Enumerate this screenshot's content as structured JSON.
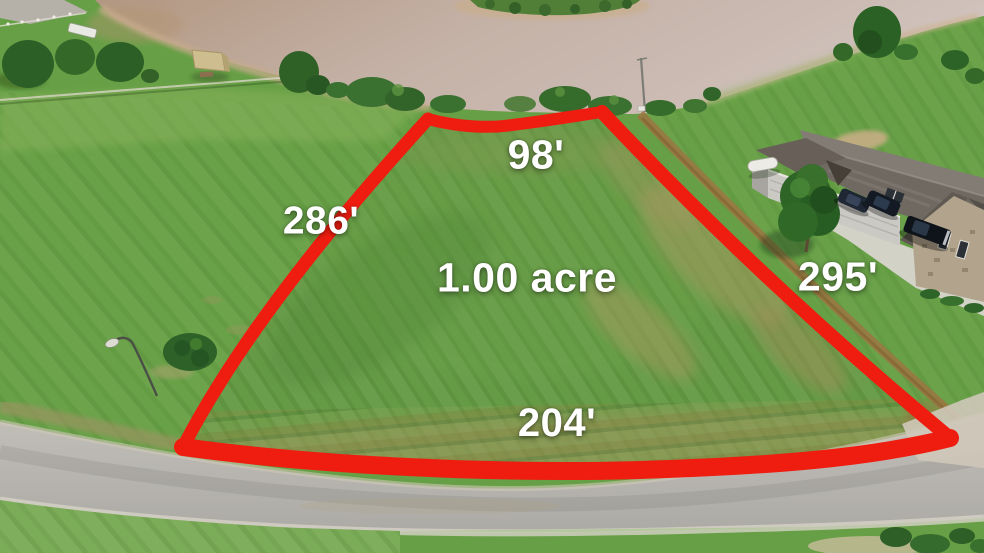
{
  "overlay": {
    "labels": {
      "top_width": "98'",
      "left_side": "286'",
      "area": "1.00 acre",
      "right_side": "295'",
      "bottom_width": "204'"
    },
    "boundary_color": "#ef1d10",
    "label_color": "#ffffff"
  },
  "scene": {
    "type": "aerial-drone-photo-of-vacant-lot",
    "colors": {
      "grass": "#669f45",
      "water": "#c7b5ab",
      "road": "#b7b4ae",
      "roof": "#6f6961",
      "dirt_trail": "#9c7642",
      "driveway_concrete": "#d8d5ce"
    },
    "features": {
      "water": "muddy-pond",
      "island": "grass-islet-top-center",
      "dock": "covered-boat-dock",
      "house": "gray-roof-house-with-stone-gable",
      "vehicles": [
        "dark-suv",
        "dark-suv",
        "black-pickup-truck"
      ],
      "road": "asphalt-street-bottom",
      "street_lamp": "lamp-post-left",
      "utility_pole": "pole-at-lot-corner",
      "lot_surface": "mowed-grass-with-brown-ruts"
    }
  }
}
